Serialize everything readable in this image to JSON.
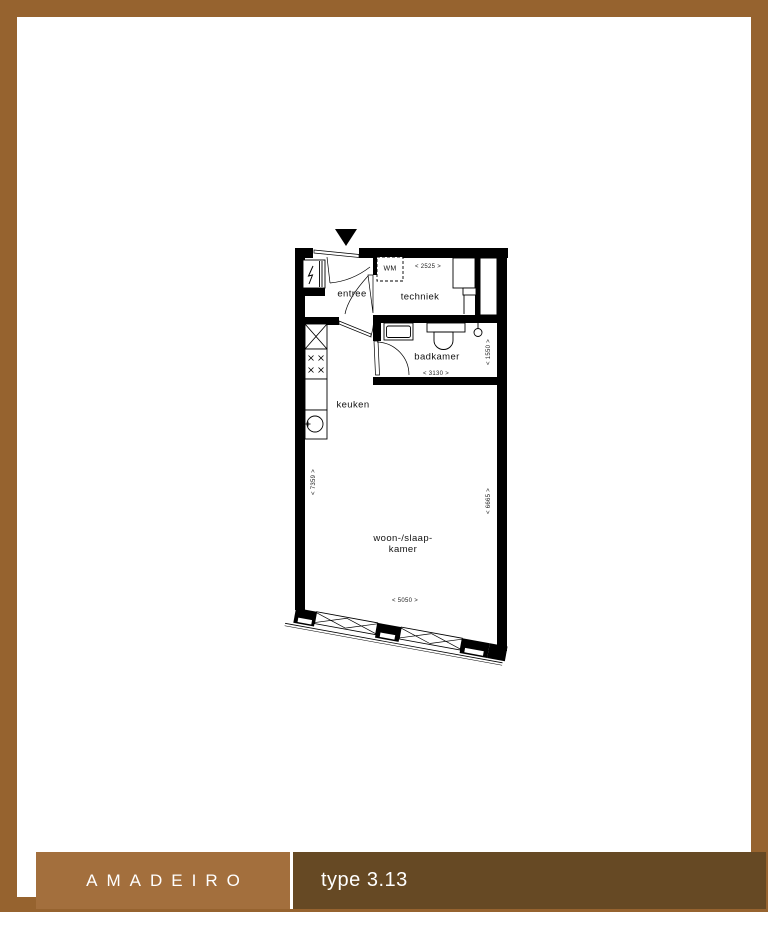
{
  "footer": {
    "brand": "AMADEIRO",
    "type": "type 3.13"
  },
  "colors": {
    "page_border": "#96632F",
    "footer_left_bg": "#A36F3D",
    "footer_right_bg": "#664924",
    "plan_line": "#000000"
  },
  "plan": {
    "rooms": {
      "entree": "entree",
      "techniek": "techniek",
      "badkamer": "badkamer",
      "keuken": "keuken",
      "woonslaapkamer_line1": "woon-/slaap-",
      "woonslaapkamer_line2": "kamer"
    },
    "appliances": {
      "washing_machine": "WM"
    },
    "dimensions": {
      "techniek_width": "< 2525 >",
      "badkamer_width": "< 3130 >",
      "badkamer_depth": "< 1550 >",
      "left_depth": "< 7359 >",
      "right_depth": "< 6665 >",
      "facade_width": "< 5050 >"
    }
  }
}
